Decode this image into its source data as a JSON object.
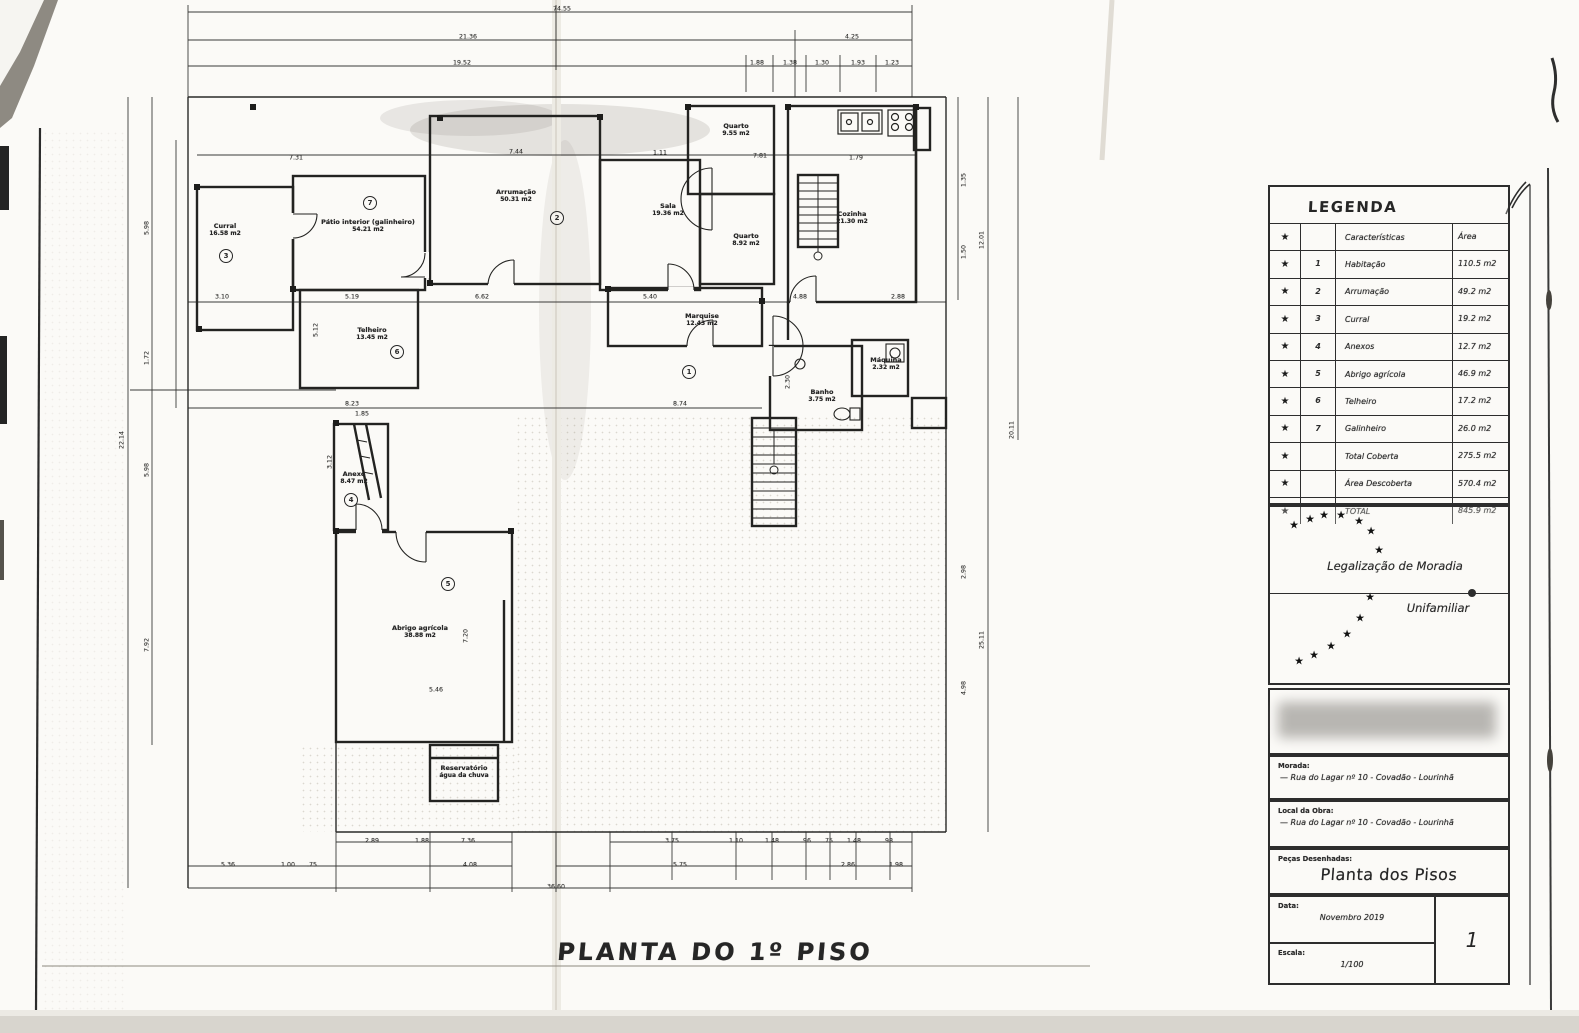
{
  "icons": {
    "star": "★"
  },
  "main_title": "PLANTA DO 1º PISO",
  "legend": {
    "title": "LEGENDA",
    "rows": [
      {
        "star": true,
        "num": "",
        "name": "Características",
        "area": "Área"
      },
      {
        "star": true,
        "num": "1",
        "name": "Habitação",
        "area": "110.5 m2"
      },
      {
        "star": true,
        "num": "2",
        "name": "Arrumação",
        "area": "49.2 m2"
      },
      {
        "star": true,
        "num": "3",
        "name": "Curral",
        "area": "19.2 m2"
      },
      {
        "star": true,
        "num": "4",
        "name": "Anexos",
        "area": "12.7 m2"
      },
      {
        "star": true,
        "num": "5",
        "name": "Abrigo agrícola",
        "area": "46.9 m2"
      },
      {
        "star": true,
        "num": "6",
        "name": "Telheiro",
        "area": "17.2 m2"
      },
      {
        "star": true,
        "num": "7",
        "name": "Galinheiro",
        "area": "26.0 m2"
      },
      {
        "star": true,
        "num": "",
        "name": "Total Coberta",
        "area": "275.5 m2"
      },
      {
        "star": true,
        "num": "",
        "name": "Área Descoberta",
        "area": "570.4 m2"
      },
      {
        "star": true,
        "num": "",
        "name": "TOTAL",
        "area": "845.9 m2"
      }
    ]
  },
  "stamp": {
    "line1": "Legalização de Moradia",
    "line2": "Unifamiliar",
    "stars": [
      {
        "x": 24,
        "y": 18
      },
      {
        "x": 40,
        "y": 12
      },
      {
        "x": 54,
        "y": 8
      },
      {
        "x": 71,
        "y": 8
      },
      {
        "x": 89,
        "y": 14
      },
      {
        "x": 101,
        "y": 24
      },
      {
        "x": 109,
        "y": 43
      },
      {
        "x": 100,
        "y": 90
      },
      {
        "x": 90,
        "y": 111
      },
      {
        "x": 77,
        "y": 127
      },
      {
        "x": 61,
        "y": 139
      },
      {
        "x": 44,
        "y": 148
      },
      {
        "x": 29,
        "y": 154
      }
    ]
  },
  "titleblock": {
    "morada_label": "Morada:",
    "morada_value": "— Rua do Lagar nº 10  -  Covadão  -  Lourinhã",
    "local_label": "Local da Obra:",
    "local_value": "— Rua do Lagar nº 10  -  Covadão  -  Lourinhã",
    "pecas_label": "Peças Desenhadas:",
    "pecas_value": "Planta dos Pisos",
    "data_label": "Data:",
    "data_value": "Novembro 2019",
    "escala_label": "Escala:",
    "escala_value": "1/100",
    "sheet_number": "1"
  },
  "plan": {
    "scale_note": "1/100",
    "rooms": [
      {
        "l": "Curral",
        "a": "16.58 m2",
        "x": 225,
        "y": 230
      },
      {
        "l": "Pátio interior (galinheiro)",
        "a": "54.21 m2",
        "x": 368,
        "y": 226
      },
      {
        "l": "Arrumação",
        "a": "50.31 m2",
        "x": 516,
        "y": 196
      },
      {
        "l": "Sala",
        "a": "19.36 m2",
        "x": 668,
        "y": 210
      },
      {
        "l": "Quarto",
        "a": "9.55 m2",
        "x": 736,
        "y": 130
      },
      {
        "l": "Quarto",
        "a": "8.92 m2",
        "x": 746,
        "y": 240
      },
      {
        "l": "Cozinha",
        "a": "21.30 m2",
        "x": 852,
        "y": 218
      },
      {
        "l": "Marquise",
        "a": "12.43 m2",
        "x": 702,
        "y": 320
      },
      {
        "l": "Banho",
        "a": "3.75 m2",
        "x": 822,
        "y": 396
      },
      {
        "l": "Máquina",
        "a": "2.32 m2",
        "x": 886,
        "y": 364
      },
      {
        "l": "Telheiro",
        "a": "13.45 m2",
        "x": 372,
        "y": 334
      },
      {
        "l": "Anexo",
        "a": "8.47 m2",
        "x": 354,
        "y": 478
      },
      {
        "l": "Abrigo agrícola",
        "a": "38.88 m2",
        "x": 420,
        "y": 632
      },
      {
        "l": "Reservatório",
        "a": "água da chuva",
        "x": 464,
        "y": 772
      }
    ],
    "markers": [
      {
        "n": "7",
        "x": 370,
        "y": 203
      },
      {
        "n": "2",
        "x": 557,
        "y": 218
      },
      {
        "n": "3",
        "x": 226,
        "y": 256
      },
      {
        "n": "6",
        "x": 397,
        "y": 352
      },
      {
        "n": "1",
        "x": 689,
        "y": 372
      },
      {
        "n": "4",
        "x": 351,
        "y": 500
      },
      {
        "n": "5",
        "x": 448,
        "y": 584
      }
    ],
    "dims": [
      {
        "t": "74.55",
        "x": 562,
        "y": 9
      },
      {
        "t": "21.36",
        "x": 468,
        "y": 37
      },
      {
        "t": "4.25",
        "x": 852,
        "y": 37
      },
      {
        "t": "19.52",
        "x": 462,
        "y": 63
      },
      {
        "t": "1.88",
        "x": 757,
        "y": 63
      },
      {
        "t": "1.38",
        "x": 790,
        "y": 63
      },
      {
        "t": "1.30",
        "x": 822,
        "y": 63
      },
      {
        "t": "1.93",
        "x": 858,
        "y": 63
      },
      {
        "t": "1.23",
        "x": 892,
        "y": 63
      },
      {
        "t": "7.31",
        "x": 296,
        "y": 158
      },
      {
        "t": "7.44",
        "x": 516,
        "y": 152
      },
      {
        "t": "1.11",
        "x": 660,
        "y": 153
      },
      {
        "t": "7.81",
        "x": 760,
        "y": 156
      },
      {
        "t": "1.79",
        "x": 856,
        "y": 158
      },
      {
        "t": "3.10",
        "x": 222,
        "y": 297
      },
      {
        "t": "5.19",
        "x": 352,
        "y": 297
      },
      {
        "t": "6.62",
        "x": 482,
        "y": 297
      },
      {
        "t": "5.40",
        "x": 650,
        "y": 297
      },
      {
        "t": "4.88",
        "x": 800,
        "y": 297
      },
      {
        "t": "2.88",
        "x": 898,
        "y": 297
      },
      {
        "t": "8.23",
        "x": 352,
        "y": 404
      },
      {
        "t": "8.74",
        "x": 680,
        "y": 404
      },
      {
        "t": "1.85",
        "x": 362,
        "y": 414
      },
      {
        "t": "5.12",
        "x": 316,
        "y": 330,
        "v": 1
      },
      {
        "t": "3.12",
        "x": 330,
        "y": 462,
        "v": 1
      },
      {
        "t": "7.20",
        "x": 466,
        "y": 636,
        "v": 1
      },
      {
        "t": "5.46",
        "x": 436,
        "y": 690
      },
      {
        "t": "2.30",
        "x": 788,
        "y": 382,
        "v": 1
      },
      {
        "t": "22.14",
        "x": 122,
        "y": 440,
        "v": 1
      },
      {
        "t": "5.98",
        "x": 147,
        "y": 228,
        "v": 1
      },
      {
        "t": "1.72",
        "x": 147,
        "y": 358,
        "v": 1
      },
      {
        "t": "5.98",
        "x": 147,
        "y": 470,
        "v": 1
      },
      {
        "t": "7.92",
        "x": 147,
        "y": 645,
        "v": 1
      },
      {
        "t": "1.35",
        "x": 964,
        "y": 180,
        "v": 1
      },
      {
        "t": "1.50",
        "x": 964,
        "y": 252,
        "v": 1
      },
      {
        "t": "12.01",
        "x": 982,
        "y": 240,
        "v": 1
      },
      {
        "t": "20.11",
        "x": 1012,
        "y": 430,
        "v": 1
      },
      {
        "t": "2.98",
        "x": 964,
        "y": 572,
        "v": 1
      },
      {
        "t": "4.98",
        "x": 964,
        "y": 688,
        "v": 1
      },
      {
        "t": "25.11",
        "x": 982,
        "y": 640,
        "v": 1
      },
      {
        "t": "2.89",
        "x": 372,
        "y": 841
      },
      {
        "t": "1.88",
        "x": 422,
        "y": 841
      },
      {
        "t": "7.36",
        "x": 468,
        "y": 841
      },
      {
        "t": "3.75",
        "x": 672,
        "y": 841
      },
      {
        "t": "1.10",
        "x": 736,
        "y": 841
      },
      {
        "t": "1.48",
        "x": 772,
        "y": 841
      },
      {
        "t": ".96",
        "x": 806,
        "y": 841
      },
      {
        "t": ".75",
        "x": 828,
        "y": 841
      },
      {
        "t": "1.48",
        "x": 854,
        "y": 841
      },
      {
        "t": ".98",
        "x": 888,
        "y": 841
      },
      {
        "t": "5.36",
        "x": 228,
        "y": 865
      },
      {
        "t": "1.00",
        "x": 288,
        "y": 865
      },
      {
        "t": ".75",
        "x": 312,
        "y": 865
      },
      {
        "t": "4.08",
        "x": 470,
        "y": 865
      },
      {
        "t": "5.75",
        "x": 680,
        "y": 865
      },
      {
        "t": "2.86",
        "x": 848,
        "y": 865
      },
      {
        "t": "1.98",
        "x": 896,
        "y": 865
      },
      {
        "t": "36.60",
        "x": 556,
        "y": 887
      }
    ]
  }
}
